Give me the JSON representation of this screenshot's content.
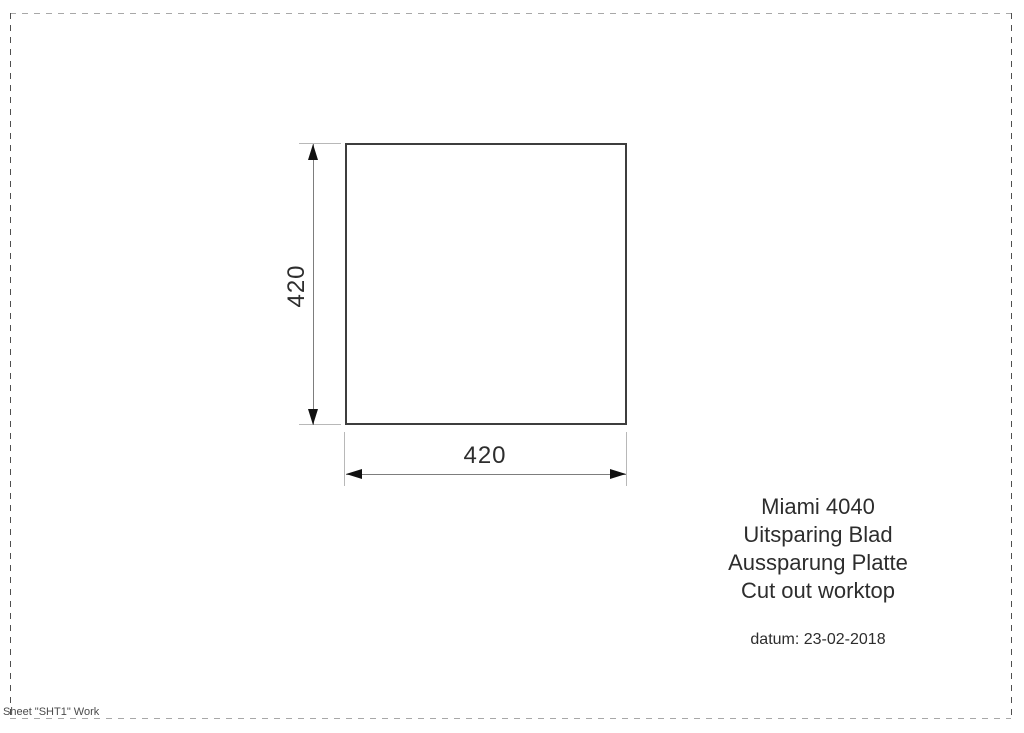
{
  "sheet": {
    "footer_label": "Sheet \"SHT1\" Work"
  },
  "drawing": {
    "type": "worktop cut-out dimension drawing",
    "cutout_width_mm": "420",
    "cutout_height_mm": "420"
  },
  "title_block": {
    "lines": [
      "Miami 4040",
      "Uitsparing Blad",
      "Aussparung Platte",
      "Cut out worktop"
    ],
    "date_label": "datum: 23-02-2018"
  },
  "colors": {
    "outline": "#3d3d3d",
    "dimension_line": "#7d7d7d",
    "extension_line": "#b8b8b8",
    "arrowhead": "#111111",
    "sheet_border_dash_horizontal": "#a8a8a8",
    "sheet_border_dash_vertical": "#4f4f4f",
    "text": "#2d2d2d",
    "footer_text": "#4a4a4a",
    "background": "#ffffff"
  }
}
